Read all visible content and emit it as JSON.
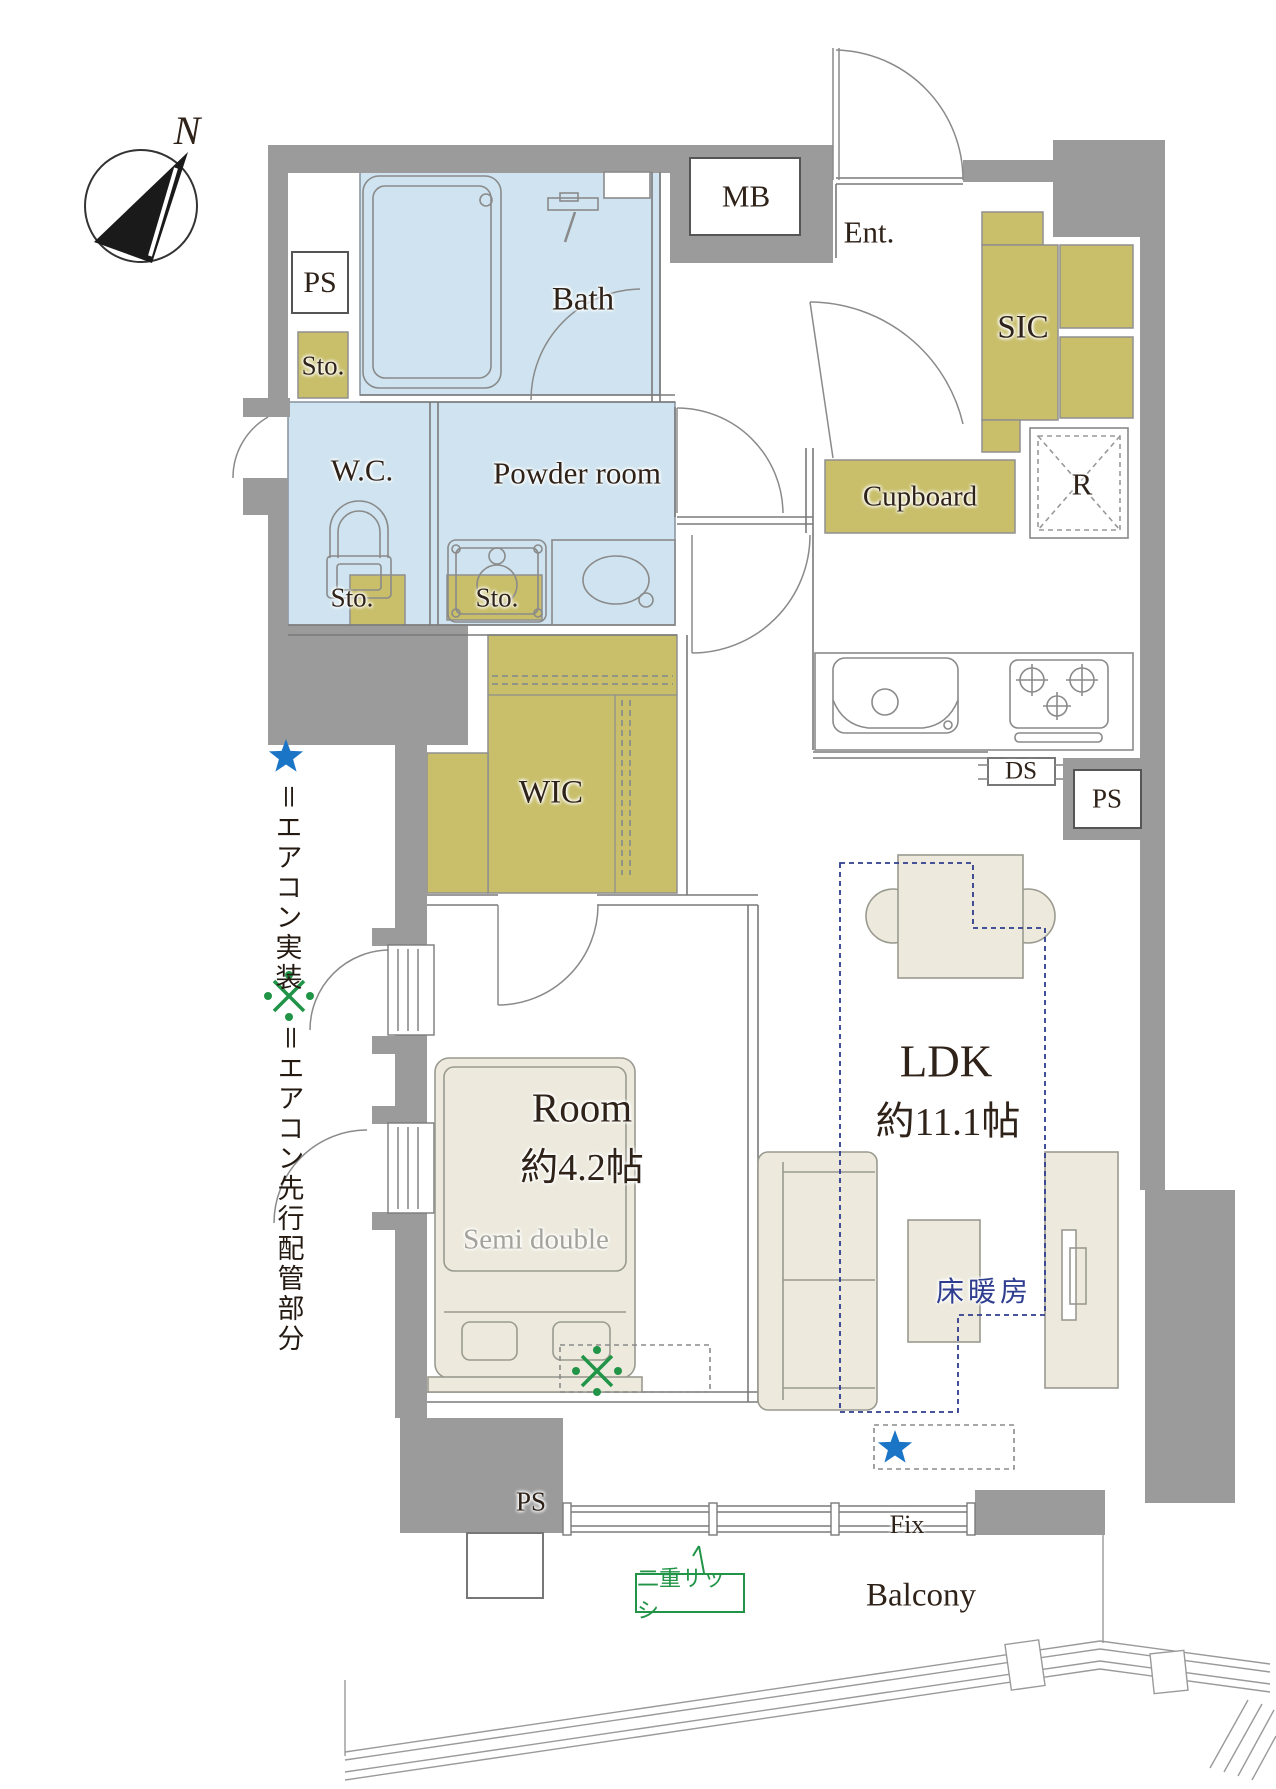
{
  "plan": {
    "compass_n": "N",
    "rooms": {
      "bath": "Bath",
      "wc": "W.C.",
      "powder_room": "Powder room",
      "wic": "WIC",
      "sic": "SIC",
      "ent": "Ent.",
      "room_name": "Room",
      "room_size": "約4.2帖",
      "ldk_name": "LDK",
      "ldk_size": "約11.1帖",
      "balcony": "Balcony"
    },
    "labels": {
      "mb": "MB",
      "ps_top": "PS",
      "ps_right": "PS",
      "ps_bottom": "PS",
      "ds": "DS",
      "r": "R",
      "cupboard": "Cupboard",
      "sto_hall": "Sto.",
      "sto_wc": "Sto.",
      "sto_powder": "Sto.",
      "bed": "Semi double",
      "floor_heating": "床暖房",
      "fix": "Fix",
      "double_sash": "二重サッシ"
    },
    "legend": {
      "star_text": "＝エアコン実装",
      "kome_text": "＝エアコン先行配管部分"
    },
    "colors": {
      "wall": "#9b9b9b",
      "wet_room": "#cfe4f0",
      "storage": "#c9bf6a",
      "furniture": "#edeadd",
      "star_blue": "#1b75c6",
      "green": "#219447",
      "navy": "#2e3d8f"
    }
  }
}
